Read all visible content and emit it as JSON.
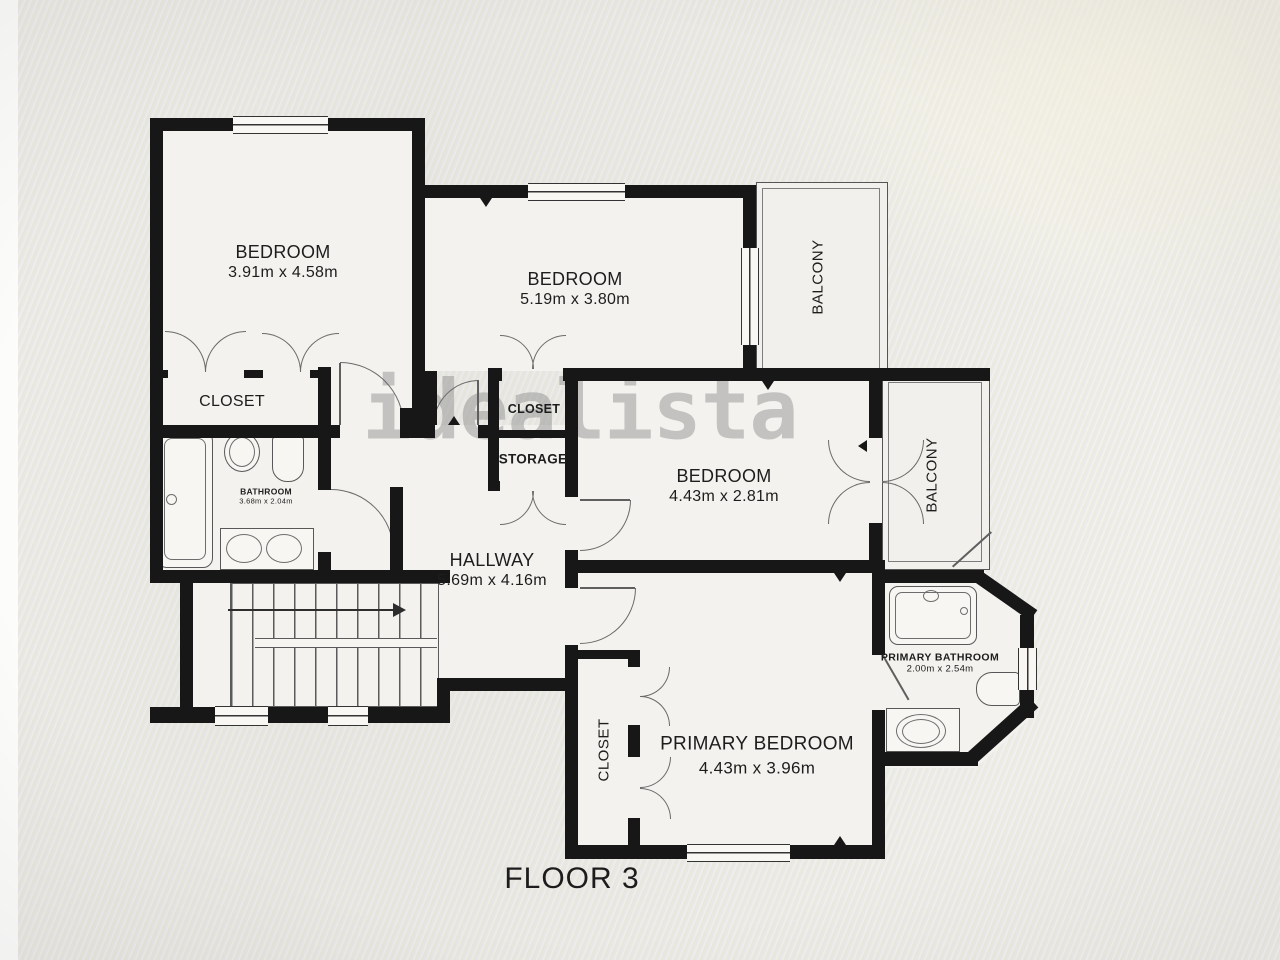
{
  "floorplan": {
    "watermark": "idealista",
    "floor_label": "FLOOR 3",
    "rooms": {
      "bedroom_top_left": {
        "name": "BEDROOM",
        "dims": "3.91m x 4.58m"
      },
      "bedroom_top_mid": {
        "name": "BEDROOM",
        "dims": "5.19m x 3.80m"
      },
      "bedroom_mid": {
        "name": "BEDROOM",
        "dims": "4.43m x 2.81m"
      },
      "primary_bedroom": {
        "name": "PRIMARY BEDROOM",
        "dims": "4.43m x 3.96m"
      },
      "hallway": {
        "name": "HALLWAY",
        "dims": "5.69m x 4.16m"
      },
      "bathroom": {
        "name": "BATHROOM",
        "dims": "3.68m x 2.04m"
      },
      "primary_bathroom": {
        "name": "PRIMARY BATHROOM",
        "dims": "2.00m x 2.54m"
      },
      "closet_bedroom1": {
        "name": "CLOSET"
      },
      "closet_mid": {
        "name": "CLOSET"
      },
      "storage": {
        "name": "STORAGE"
      },
      "closet_primary": {
        "name": "CLOSET"
      },
      "balcony_top": {
        "name": "BALCONY"
      },
      "balcony_mid": {
        "name": "BALCONY"
      }
    }
  }
}
